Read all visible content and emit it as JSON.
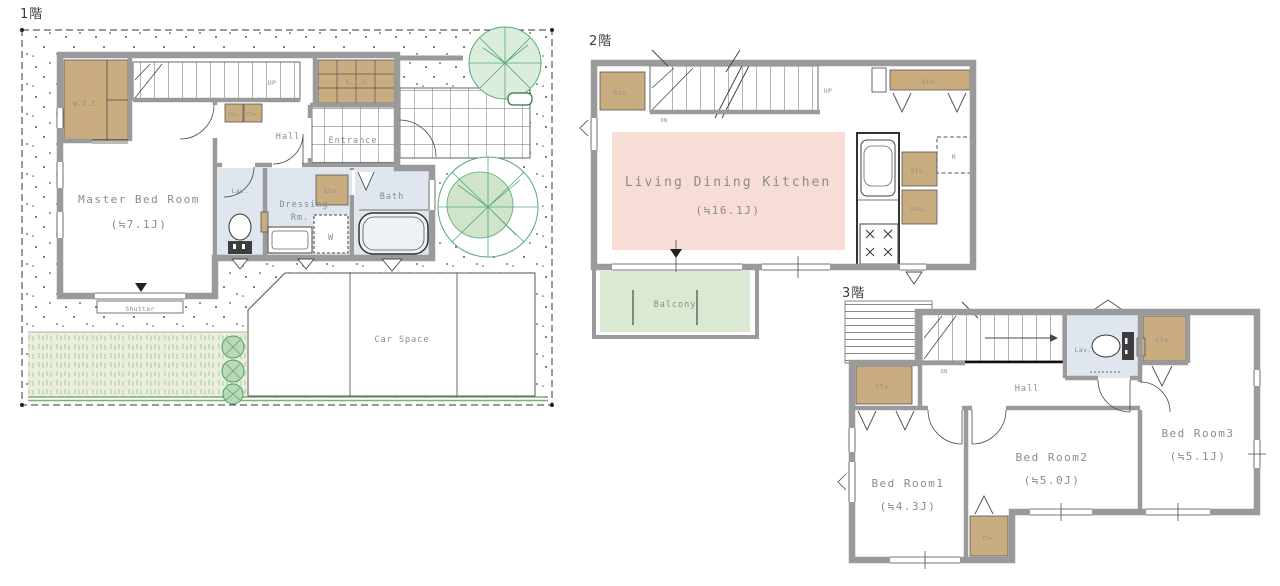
{
  "colors": {
    "wall": "#9a9a9a",
    "closet": "#c9ad80",
    "ldk": "#f8ddd7",
    "balcony": "#dce9d2",
    "wet": "#dfe6ee",
    "grass": "#e9efda",
    "tree": "#57a878",
    "tree_fill": "#ddeddd",
    "label": "#8b8b88",
    "floor_label": "#3c3c3c"
  },
  "floor1": {
    "label": "1階",
    "wic": "W.I.C.",
    "sto_small": "Sto.",
    "clo_small": "Clo.",
    "up": "UP",
    "sic": "S.I.C",
    "hall": "Hall",
    "entrance": "Entrance",
    "lav": "Lav.",
    "dressing_line1": "Dressing",
    "dressing_line2": "Rm.",
    "sto": "Sto.",
    "washer": "W",
    "bath": "Bath",
    "master": "Master Bed Room",
    "master_size": "(≒7.1J)",
    "shutter": "Shutter",
    "car_space": "Car Space"
  },
  "floor2": {
    "label": "2階",
    "sto_left": "Sto.",
    "dn": "DN",
    "up": "UP",
    "sto_right": "Sto.",
    "ldk": "Living Dining Kitchen",
    "ldk_size": "(≒16.1J)",
    "sto_mid1": "Sto.",
    "sto_mid2": "Sto.",
    "fridge": "R",
    "balcony": "Balcony"
  },
  "floor3": {
    "label": "3階",
    "dn": "DN",
    "hall": "Hall",
    "lav": "Lav.",
    "clo_right": "Clo.",
    "clo_left": "Clo.",
    "clo_bottom": "Clo.",
    "bed1": "Bed Room1",
    "bed1_size": "(≒4.3J)",
    "bed2": "Bed Room2",
    "bed2_size": "(≒5.0J)",
    "bed3": "Bed Room3",
    "bed3_size": "(≒5.1J)"
  }
}
